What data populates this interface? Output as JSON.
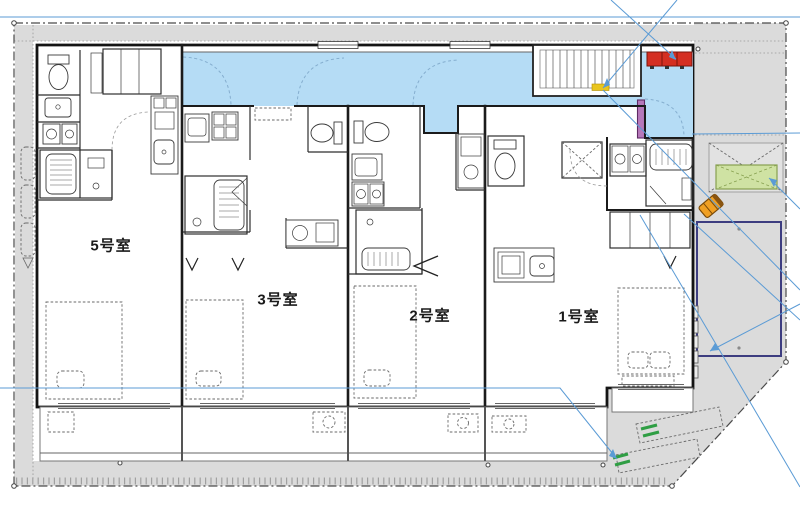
{
  "meta": {
    "document_type": "architectural floor plan (site + first floor apartment layout)",
    "language": "ja"
  },
  "rooms": [
    {
      "id": "room-5",
      "label": "5号室"
    },
    {
      "id": "room-3",
      "label": "3号室"
    },
    {
      "id": "room-2",
      "label": "2号室"
    },
    {
      "id": "room-1",
      "label": "1号室"
    }
  ],
  "colors": {
    "corridor_blue": "#b5dcf5",
    "annotation_blue": "#5b9bd5",
    "meter_box_red": "#d42f22",
    "stair_marker_yellow": "#e9c51e",
    "highlight_wall_purple": "#b678ba",
    "planter_green": "#cfe2a3",
    "wheel_stop_green": "#2f9e44",
    "parking_border_navy": "#3d3d80",
    "scooter_orange": "#f0a024",
    "ground_gray": "#dbdbdb"
  },
  "site_features": [
    "shared corridor (blue)",
    "staircase with landing marker",
    "meter/mail boxes (red)",
    "bicycle parking strip (left)",
    "planter / refuse area (green)",
    "parking bay (navy outline)",
    "two angled parking spots with wheel stops",
    "scooter (orange)"
  ]
}
